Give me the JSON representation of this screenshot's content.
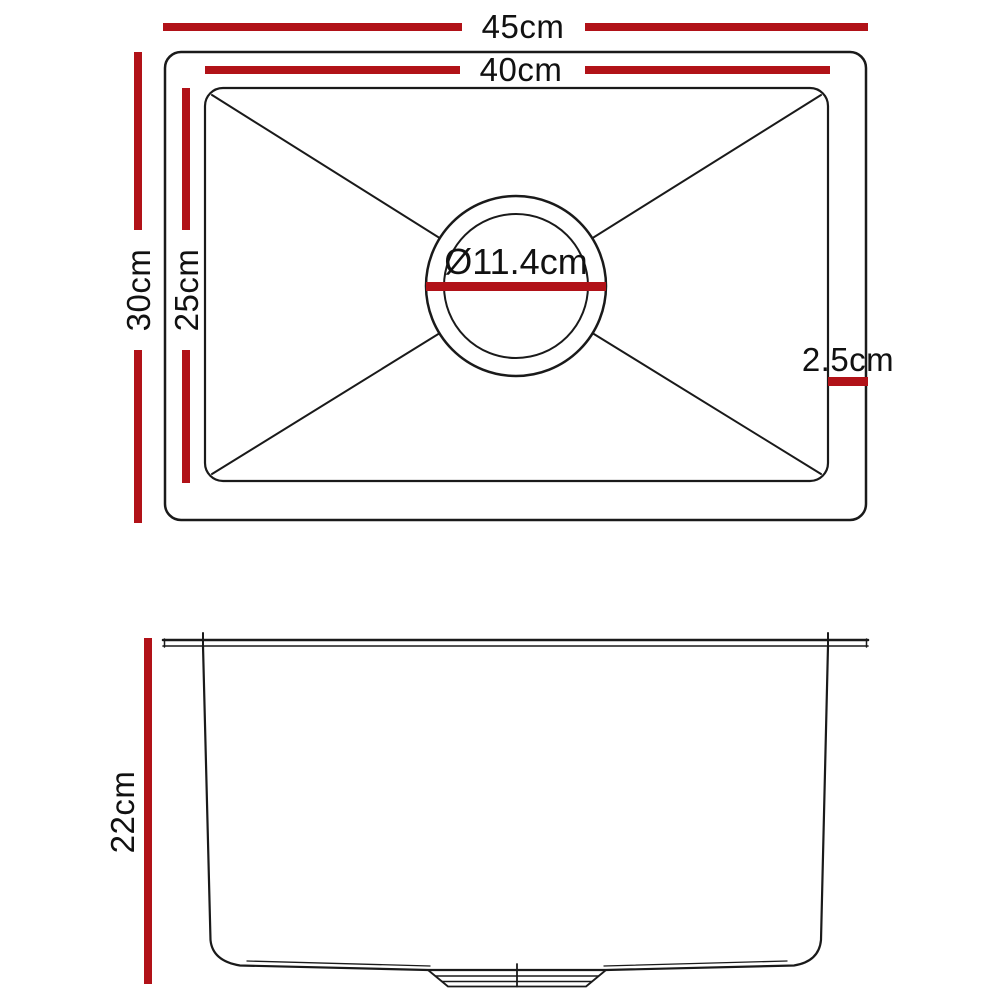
{
  "colors": {
    "dimension_red": "#b11218",
    "line": "#1a1a1a",
    "text": "#111111",
    "background": "#ffffff"
  },
  "views": {
    "top_view": {
      "labels": {
        "outer_width": "45cm",
        "inner_width": "40cm",
        "outer_depth": "30cm",
        "inner_depth": "25cm",
        "drain_diameter": "Ø11.4cm",
        "rim_offset": "2.5cm"
      }
    },
    "side_view": {
      "labels": {
        "bowl_depth": "22cm"
      }
    }
  },
  "dimensions_cm": {
    "outer_width": 45,
    "inner_width": 40,
    "outer_depth": 30,
    "inner_depth": 25,
    "drain_diameter": 11.4,
    "rim_offset": 2.5,
    "bowl_depth": 22
  }
}
